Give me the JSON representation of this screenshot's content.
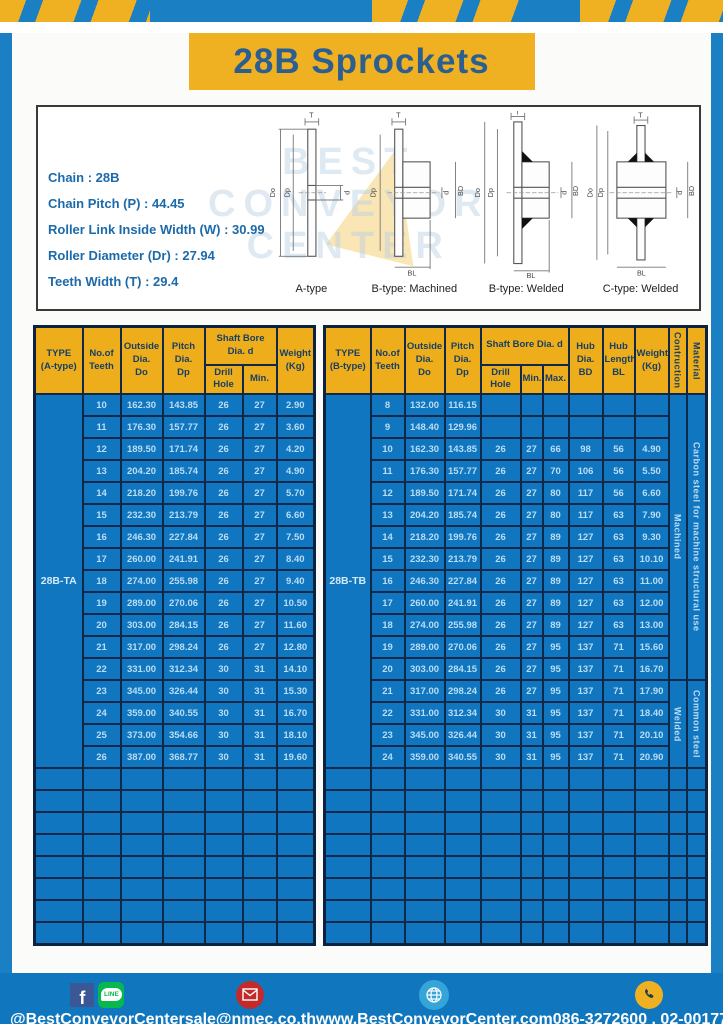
{
  "page": {
    "title": "28B Sprockets"
  },
  "specs": {
    "lines": [
      "Chain : 28B",
      "Chain Pitch (P) : 44.45",
      "Roller Link Inside Width (W) : 30.99",
      "Roller Diameter (Dr) : 27.94",
      "Teeth Width (T) : 29.4"
    ]
  },
  "watermark": {
    "lines": [
      "BEST",
      "CONVEYOR",
      "CENTER"
    ]
  },
  "diagrams": {
    "labels": {
      "t": "T",
      "do": "Do",
      "dp": "Dp",
      "d": "d",
      "bd": "BD",
      "bl": "BL"
    },
    "captions": [
      "A-type",
      "B-type: Machined",
      "B-type: Welded",
      "C-type: Welded"
    ]
  },
  "left_table": {
    "headers": {
      "type": "TYPE\n(A-type)",
      "teeth": "No.of\nTeeth",
      "outside": "Outside\nDia.\nDo",
      "pitch": "Pitch Dia.\nDp",
      "shaft": "Shaft Bore Dia. d",
      "drill": "Drill Hole",
      "min": "Min.",
      "weight": "Weight\n(Kg)"
    },
    "type_label": "28B-TA",
    "rows": [
      [
        "10",
        "162.30",
        "143.85",
        "26",
        "27",
        "2.90"
      ],
      [
        "11",
        "176.30",
        "157.77",
        "26",
        "27",
        "3.60"
      ],
      [
        "12",
        "189.50",
        "171.74",
        "26",
        "27",
        "4.20"
      ],
      [
        "13",
        "204.20",
        "185.74",
        "26",
        "27",
        "4.90"
      ],
      [
        "14",
        "218.20",
        "199.76",
        "26",
        "27",
        "5.70"
      ],
      [
        "15",
        "232.30",
        "213.79",
        "26",
        "27",
        "6.60"
      ],
      [
        "16",
        "246.30",
        "227.84",
        "26",
        "27",
        "7.50"
      ],
      [
        "17",
        "260.00",
        "241.91",
        "26",
        "27",
        "8.40"
      ],
      [
        "18",
        "274.00",
        "255.98",
        "26",
        "27",
        "9.40"
      ],
      [
        "19",
        "289.00",
        "270.06",
        "26",
        "27",
        "10.50"
      ],
      [
        "20",
        "303.00",
        "284.15",
        "26",
        "27",
        "11.60"
      ],
      [
        "21",
        "317.00",
        "298.24",
        "26",
        "27",
        "12.80"
      ],
      [
        "22",
        "331.00",
        "312.34",
        "30",
        "31",
        "14.10"
      ],
      [
        "23",
        "345.00",
        "326.44",
        "30",
        "31",
        "15.30"
      ],
      [
        "24",
        "359.00",
        "340.55",
        "30",
        "31",
        "16.70"
      ],
      [
        "25",
        "373.00",
        "354.66",
        "30",
        "31",
        "18.10"
      ],
      [
        "26",
        "387.00",
        "368.77",
        "30",
        "31",
        "19.60"
      ]
    ],
    "empty_rows": 8
  },
  "right_table": {
    "headers": {
      "type": "TYPE\n(B-type)",
      "teeth": "No.of\nTeeth",
      "outside": "Outside\nDia.\nDo",
      "pitch": "Pitch Dia.\nDp",
      "shaft": "Shaft Bore Dia. d",
      "drill": "Drill Hole",
      "min": "Min.",
      "max": "Max.",
      "hub_dia": "Hub Dia.\nBD",
      "hub_len": "Hub\nLength\nBL",
      "weight": "Weight\n(Kg)",
      "construction": "Contruction",
      "material": "Material"
    },
    "type_label": "28B-TB",
    "rows": [
      [
        "8",
        "132.00",
        "116.15",
        "",
        "",
        "",
        "",
        "",
        ""
      ],
      [
        "9",
        "148.40",
        "129.96",
        "",
        "",
        "",
        "",
        "",
        ""
      ],
      [
        "10",
        "162.30",
        "143.85",
        "26",
        "27",
        "66",
        "98",
        "56",
        "4.90"
      ],
      [
        "11",
        "176.30",
        "157.77",
        "26",
        "27",
        "70",
        "106",
        "56",
        "5.50"
      ],
      [
        "12",
        "189.50",
        "171.74",
        "26",
        "27",
        "80",
        "117",
        "56",
        "6.60"
      ],
      [
        "13",
        "204.20",
        "185.74",
        "26",
        "27",
        "80",
        "117",
        "63",
        "7.90"
      ],
      [
        "14",
        "218.20",
        "199.76",
        "26",
        "27",
        "89",
        "127",
        "63",
        "9.30"
      ],
      [
        "15",
        "232.30",
        "213.79",
        "26",
        "27",
        "89",
        "127",
        "63",
        "10.10"
      ],
      [
        "16",
        "246.30",
        "227.84",
        "26",
        "27",
        "89",
        "127",
        "63",
        "11.00"
      ],
      [
        "17",
        "260.00",
        "241.91",
        "26",
        "27",
        "89",
        "127",
        "63",
        "12.00"
      ],
      [
        "18",
        "274.00",
        "255.98",
        "26",
        "27",
        "89",
        "127",
        "63",
        "13.00"
      ],
      [
        "19",
        "289.00",
        "270.06",
        "26",
        "27",
        "95",
        "137",
        "71",
        "15.60"
      ],
      [
        "20",
        "303.00",
        "284.15",
        "26",
        "27",
        "95",
        "137",
        "71",
        "16.70"
      ],
      [
        "21",
        "317.00",
        "298.24",
        "26",
        "27",
        "95",
        "137",
        "71",
        "17.90"
      ],
      [
        "22",
        "331.00",
        "312.34",
        "30",
        "31",
        "95",
        "137",
        "71",
        "18.40"
      ],
      [
        "23",
        "345.00",
        "326.44",
        "30",
        "31",
        "95",
        "137",
        "71",
        "20.10"
      ],
      [
        "24",
        "359.00",
        "340.55",
        "30",
        "31",
        "95",
        "137",
        "71",
        "20.90"
      ]
    ],
    "construction": [
      {
        "label": "Machined",
        "span": 13
      },
      {
        "label": "Welded",
        "span": 4
      }
    ],
    "material": [
      {
        "label": "Carbon steel for machine structural use",
        "span": 13
      },
      {
        "label": "Common steel",
        "span": 4
      }
    ],
    "empty_rows": 8
  },
  "footer": {
    "icons": {
      "facebook_letter": "f",
      "line_label": "LINE"
    },
    "items": [
      {
        "text": "@BestConveyorCenter"
      },
      {
        "text": "sale@nmec.co.th"
      },
      {
        "text": "www.BestConveyorCenter.com"
      },
      {
        "text": "086-3272600 , 02-0017766"
      }
    ]
  },
  "colors": {
    "frame_blue": "#1b7fc4",
    "banner_yellow": "#efb022",
    "header_yellow": "#eeae1b",
    "table_blue": "#1176c0",
    "table_border_navy": "#10294a",
    "table_text_light": "#b9ddf5",
    "title_text_blue": "#2b5f91",
    "footer_blue": "#1077be"
  }
}
